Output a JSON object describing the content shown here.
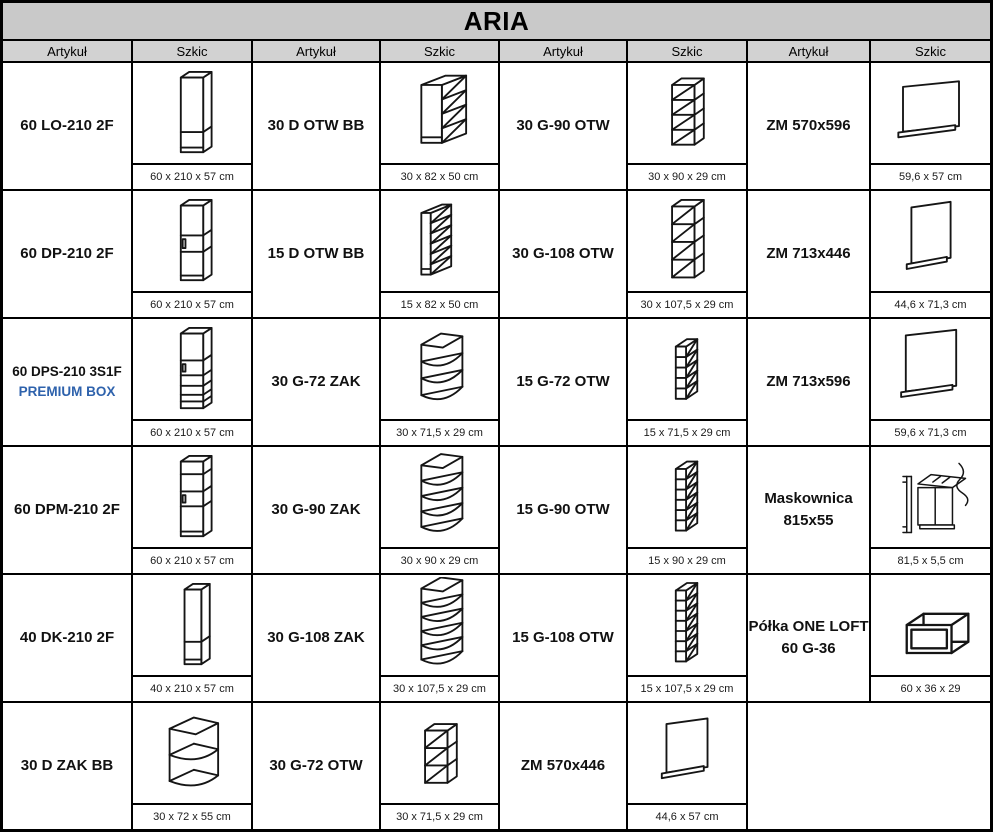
{
  "title": "ARIA",
  "header": {
    "labels": [
      "Artykuł",
      "Szkic",
      "Artykuł",
      "Szkic",
      "Artykuł",
      "Szkic",
      "Artykuł",
      "Szkic"
    ]
  },
  "colors": {
    "premium_blue": "#2e62ac",
    "title_bg": "#c9c9c9",
    "header_bg": "#d2d2d2",
    "line": "#151515"
  },
  "rows": [
    [
      {
        "name": "60 LO-210 2F",
        "sketch": "tall-cabinet-2-door",
        "dims": "60 x 210 x 57 cm"
      },
      {
        "name": "30 D OTW BB",
        "sketch": "base-open-rack-30",
        "dims": "30 x 82 x 50 cm"
      },
      {
        "name": "30 G-90 OTW",
        "sketch": "wall-open-30-90",
        "dims": "30 x 90 x 29 cm"
      },
      {
        "name": "ZM 570x596",
        "sketch": "panel-570x596",
        "dims": "59,6 x 57 cm"
      }
    ],
    [
      {
        "name": "60 DP-210 2F",
        "sketch": "tall-oven-housing",
        "dims": "60 x 210 x 57 cm"
      },
      {
        "name": "15 D OTW BB",
        "sketch": "base-open-rack-15",
        "dims": "15 x 82 x 50 cm"
      },
      {
        "name": "30 G-108 OTW",
        "sketch": "wall-open-30-108",
        "dims": "30 x 107,5 x 29 cm"
      },
      {
        "name": "ZM 713x446",
        "sketch": "panel-713x446",
        "dims": "44,6 x 71,3 cm"
      }
    ],
    [
      {
        "name": "60 DPS-210 3S1F",
        "name2": "PREMIUM BOX",
        "premium": true,
        "small": true,
        "sketch": "tall-oven-drawer-housing",
        "dims": "60 x 210 x 57 cm"
      },
      {
        "name": "30 G-72 ZAK",
        "sketch": "wall-corner-72",
        "dims": "30 x 71,5 x 29 cm"
      },
      {
        "name": "15 G-72 OTW",
        "sketch": "wall-open-15-72",
        "dims": "15 x 71,5 x 29 cm"
      },
      {
        "name": "ZM 713x596",
        "sketch": "panel-713x596",
        "dims": "59,6 x 71,3 cm"
      }
    ],
    [
      {
        "name": "60 DPM-210 2F",
        "sketch": "tall-microwave-housing",
        "dims": "60 x 210 x 57 cm"
      },
      {
        "name": "30 G-90 ZAK",
        "sketch": "wall-corner-90",
        "dims": "30 x 90 x 29 cm"
      },
      {
        "name": "15 G-90 OTW",
        "sketch": "wall-open-15-90",
        "dims": "15 x 90 x 29 cm"
      },
      {
        "name": "Maskownica",
        "name2": "815x55",
        "sketch": "maskownica-strip",
        "dims": "81,5 x 5,5 cm"
      }
    ],
    [
      {
        "name": "40 DK-210 2F",
        "sketch": "tall-cabinet-narrow",
        "dims": "40 x 210 x 57 cm"
      },
      {
        "name": "30 G-108 ZAK",
        "sketch": "wall-corner-108",
        "dims": "30 x 107,5 x 29 cm"
      },
      {
        "name": "15 G-108 OTW",
        "sketch": "wall-open-15-108",
        "dims": "15 x 107,5 x 29 cm"
      },
      {
        "name": "Półka ONE LOFT",
        "name2": "60 G-36",
        "sketch": "loft-shelf-frame",
        "dims": "60 x 36 x 29"
      }
    ],
    [
      {
        "name": "30 D ZAK BB",
        "sketch": "base-corner-open-shelf",
        "dims": "30 x 72 x 55 cm"
      },
      {
        "name": "30 G-72 OTW",
        "sketch": "wall-open-30-72",
        "dims": "30 x 71,5 x 29 cm"
      },
      {
        "name": "ZM 570x446",
        "sketch": "panel-570x446",
        "dims": "44,6 x 57 cm"
      },
      null
    ]
  ]
}
